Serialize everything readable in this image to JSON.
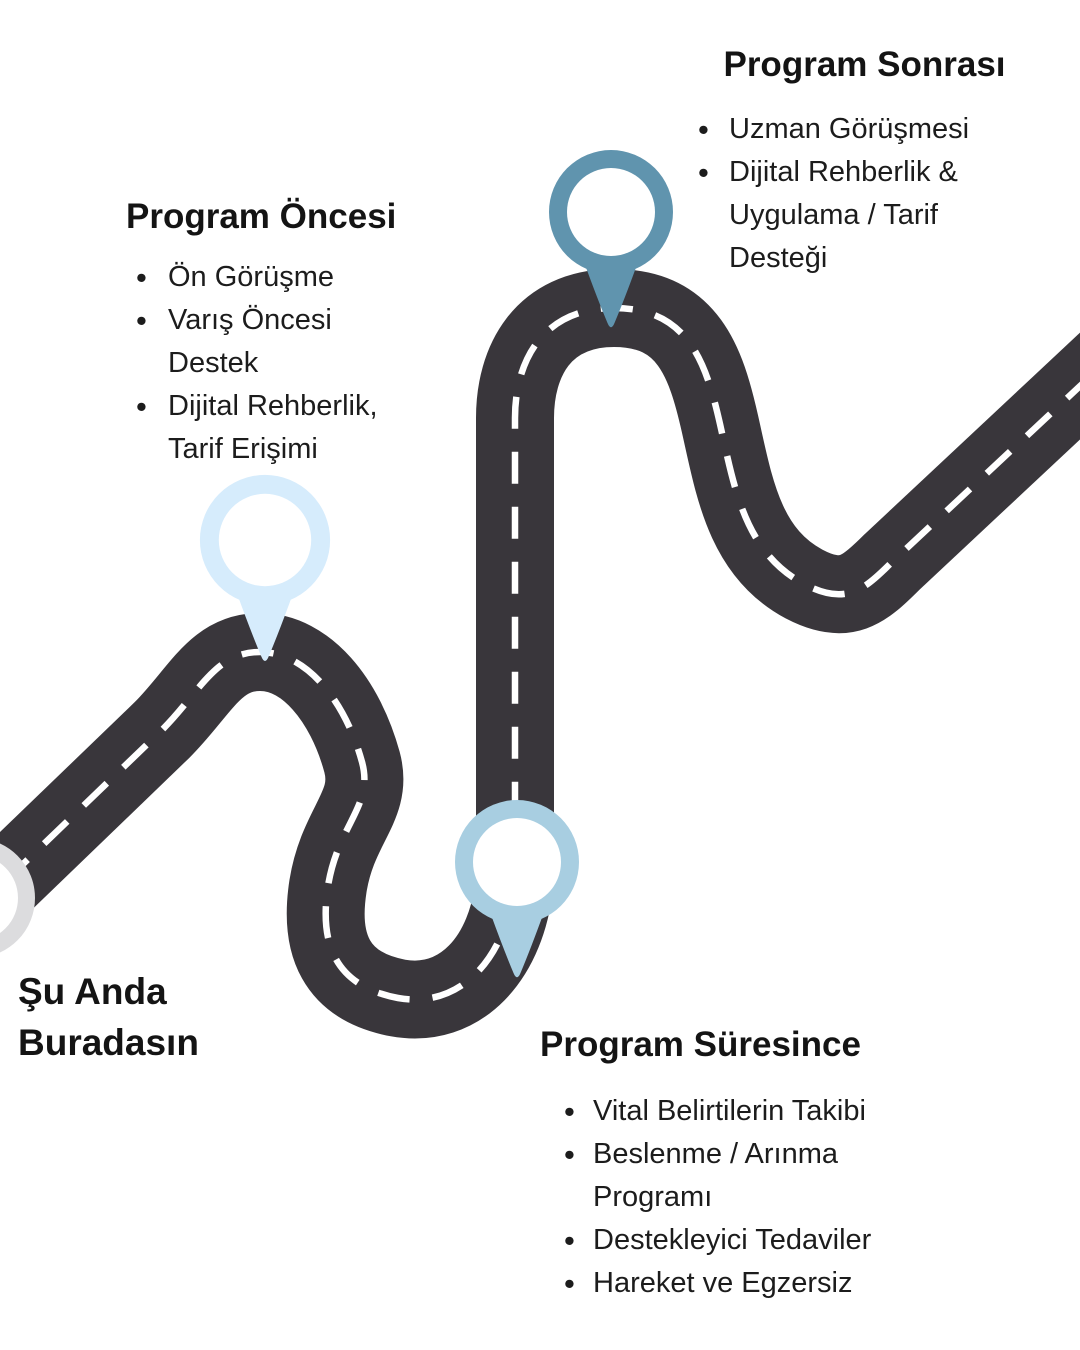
{
  "palette": {
    "road": "#39363b",
    "road_line": "#ffffff",
    "text": "#1c1c1c",
    "start_ring": "#dcdcde",
    "pin_pre": "#d6ecfc",
    "pin_during": "#a8cee1",
    "pin_post": "#6094ae"
  },
  "sections": {
    "pre": {
      "title": "Program Öncesi",
      "items": [
        "Ön Görüşme",
        "Varış Öncesi Destek",
        "Dijital Rehberlik, Tarif Erişimi"
      ]
    },
    "during": {
      "title": "Program Süresince",
      "items": [
        "Vital Belirtilerin Takibi",
        "Beslenme / Arınma Programı",
        "Destekleyici Tedaviler",
        "Hareket ve Egzersiz"
      ]
    },
    "post": {
      "title": "Program Sonrası",
      "items": [
        "Uzman Görüşmesi",
        "Dijital Rehberlik & Uygulama / Tarif Desteği"
      ]
    },
    "start": {
      "label": "Şu Anda Buradasın"
    }
  }
}
